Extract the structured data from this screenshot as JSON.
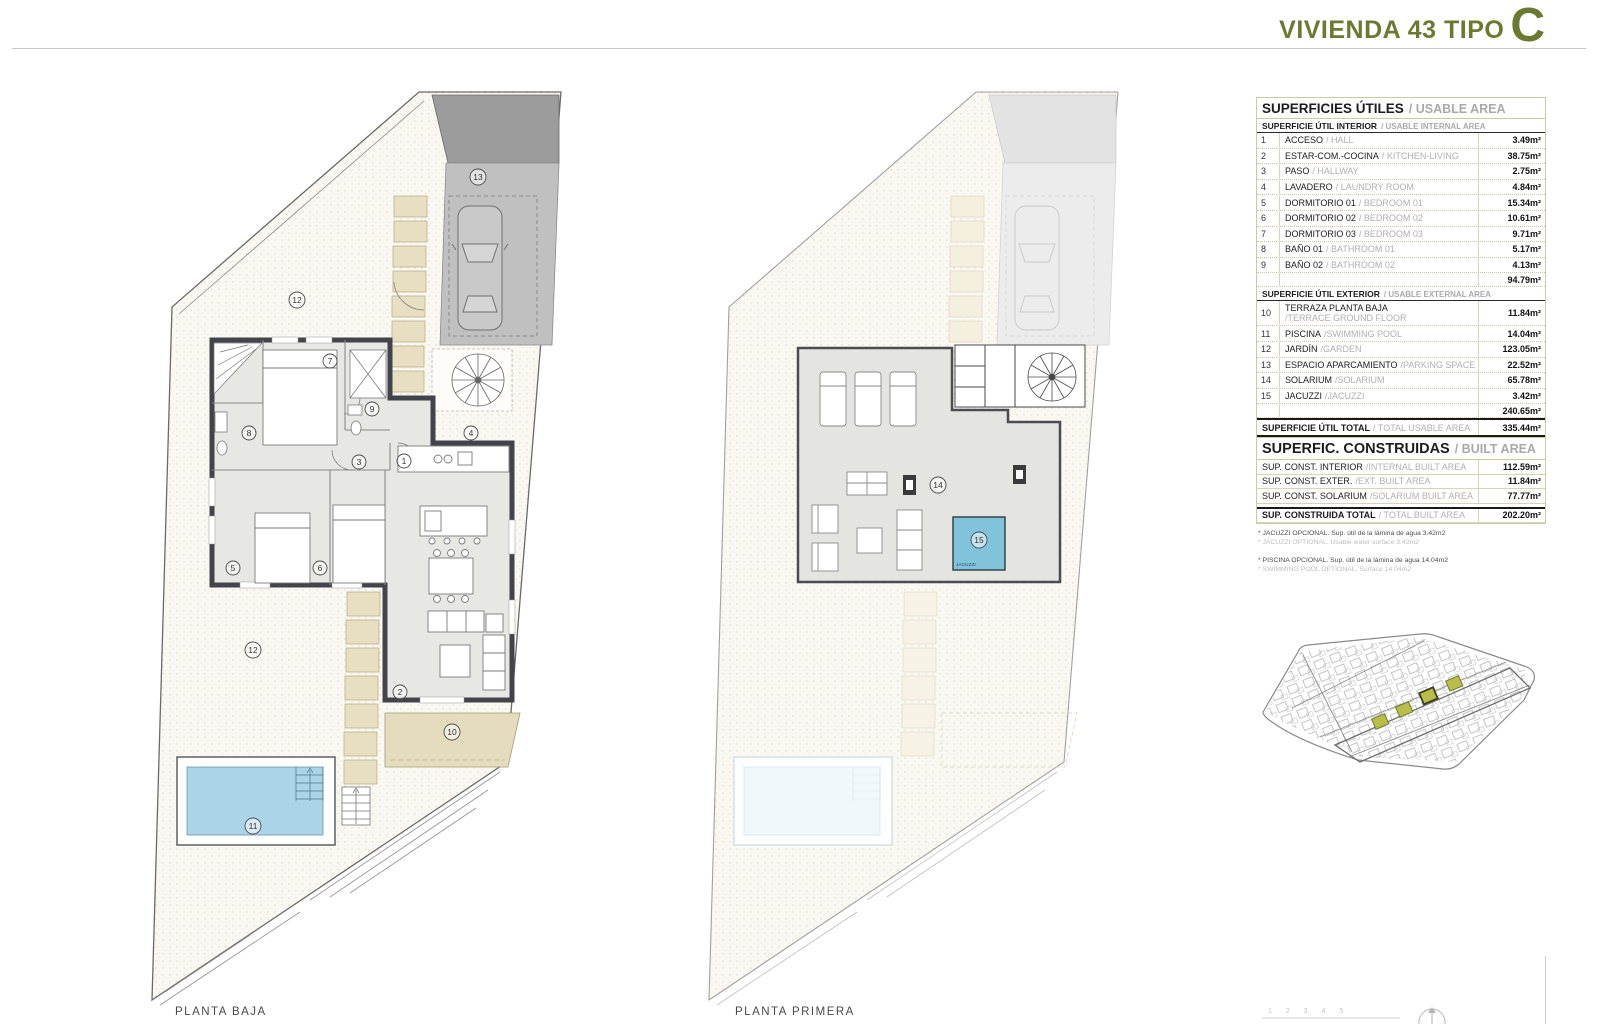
{
  "title": {
    "project": "VIVIENDA 43 TIPO",
    "letter": "C"
  },
  "accent_color": "#6c7930",
  "plan_labels": {
    "ground": "PLANTA BAJA",
    "first": "PLANTA PRIMERA",
    "jacuzzi_tag": "JACUZZI"
  },
  "scale_ticks": "1 2 3 4 5",
  "usable": {
    "title_es": "SUPERFICIES ÚTILES",
    "title_en": "/ USABLE AREA",
    "interior": {
      "header_es": "SUPERFICIE ÚTIL INTERIOR",
      "header_en": "/ USABLE INTERNAL AREA",
      "rows": [
        {
          "num": "1",
          "es": "ACCESO",
          "en": "/ HALL",
          "value": "3.49m²"
        },
        {
          "num": "2",
          "es": "ESTAR-COM.-COCINA",
          "en": "/ KITCHEN-LIVING",
          "value": "38.75m²"
        },
        {
          "num": "3",
          "es": "PASO",
          "en": "/ HALLWAY",
          "value": "2.75m²"
        },
        {
          "num": "4",
          "es": "LAVADERO",
          "en": "/ LAUNDRY ROOM",
          "value": "4.84m²"
        },
        {
          "num": "5",
          "es": "DORMITORIO 01",
          "en": "/ BEDROOM 01",
          "value": "15.34m²"
        },
        {
          "num": "6",
          "es": "DORMITORIO 02",
          "en": "/ BEDROOM 02",
          "value": "10.61m²"
        },
        {
          "num": "7",
          "es": "DORMITORIO 03",
          "en": "/ BEDROOM 03",
          "value": "9.71m²"
        },
        {
          "num": "8",
          "es": "BAÑO 01",
          "en": "/ BATHROOM 01",
          "value": "5.17m²"
        },
        {
          "num": "9",
          "es": "BAÑO 02",
          "en": "/ BATHROOM 02",
          "value": "4.13m²"
        }
      ],
      "subtotal": "94.79m²"
    },
    "exterior": {
      "header_es": "SUPERFICIE ÚTIL EXTERIOR",
      "header_en": "/ USABLE EXTERNAL AREA",
      "rows": [
        {
          "num": "10",
          "es": "TERRAZA PLANTA BAJA",
          "en": "/TERRACE GROUND FLOOR",
          "value": "11.84m²"
        },
        {
          "num": "11",
          "es": "PISCINA",
          "en": "/SWIMMING POOL",
          "value": "14.04m²"
        },
        {
          "num": "12",
          "es": "JARDÍN",
          "en": "/GARDEN",
          "value": "123.05m²"
        },
        {
          "num": "13",
          "es": "ESPACIO APARCAMIENTO",
          "en": "/PARKING SPACE",
          "value": "22.52m²"
        },
        {
          "num": "14",
          "es": "SOLARIUM",
          "en": "/SOLARIUM",
          "value": "65.78m²"
        },
        {
          "num": "15",
          "es": "JACUZZI",
          "en": "/JACUZZI",
          "value": "3.42m²"
        }
      ],
      "subtotal": "240.65m²"
    },
    "total": {
      "es": "SUPERFICIE ÚTIL TOTAL",
      "en": "/ TOTAL USABLE AREA",
      "value": "335.44m²"
    }
  },
  "built": {
    "title_es": "SUPERFIC. CONSTRUIDAS",
    "title_en": "/ BUILT AREA",
    "rows": [
      {
        "es": "SUP. CONST. INTERIOR",
        "en": "/INTERNAL BUILT AREA",
        "value": "112.59m²"
      },
      {
        "es": "SUP. CONST. EXTER.",
        "en": "/EXT. BUILT AREA",
        "value": "11.84m²"
      },
      {
        "es": "SUP. CONST. SOLARIUM",
        "en": "/SOLARIUM BUILT AREA",
        "value": "77.77m²"
      }
    ],
    "total": {
      "es": "SUP. CONSTRUIDA TOTAL",
      "en": "/ TOTAL BUILT AREA",
      "value": "202.20m²"
    }
  },
  "footnotes": [
    {
      "es": "* JACUZZI OPCIONAL. Sup. útil de la lámina de agua 3.42m2",
      "en": "* JACUZZI OPTIONAL. Usable water surface 3.42m2"
    },
    {
      "es": "* PISCINA OPCIONAL. Sup. útil de la lámina de agua 14.04m2",
      "en": "* SWIMMING POOL OPTIONAL. Surface 14.04m2"
    }
  ],
  "markers": {
    "n1": "1",
    "n2": "2",
    "n3": "3",
    "n4": "4",
    "n5": "5",
    "n6": "6",
    "n7": "7",
    "n8": "8",
    "n9": "9",
    "n10": "10",
    "n11": "11",
    "n12": "12",
    "n13": "13",
    "n14": "14",
    "n15": "15"
  }
}
